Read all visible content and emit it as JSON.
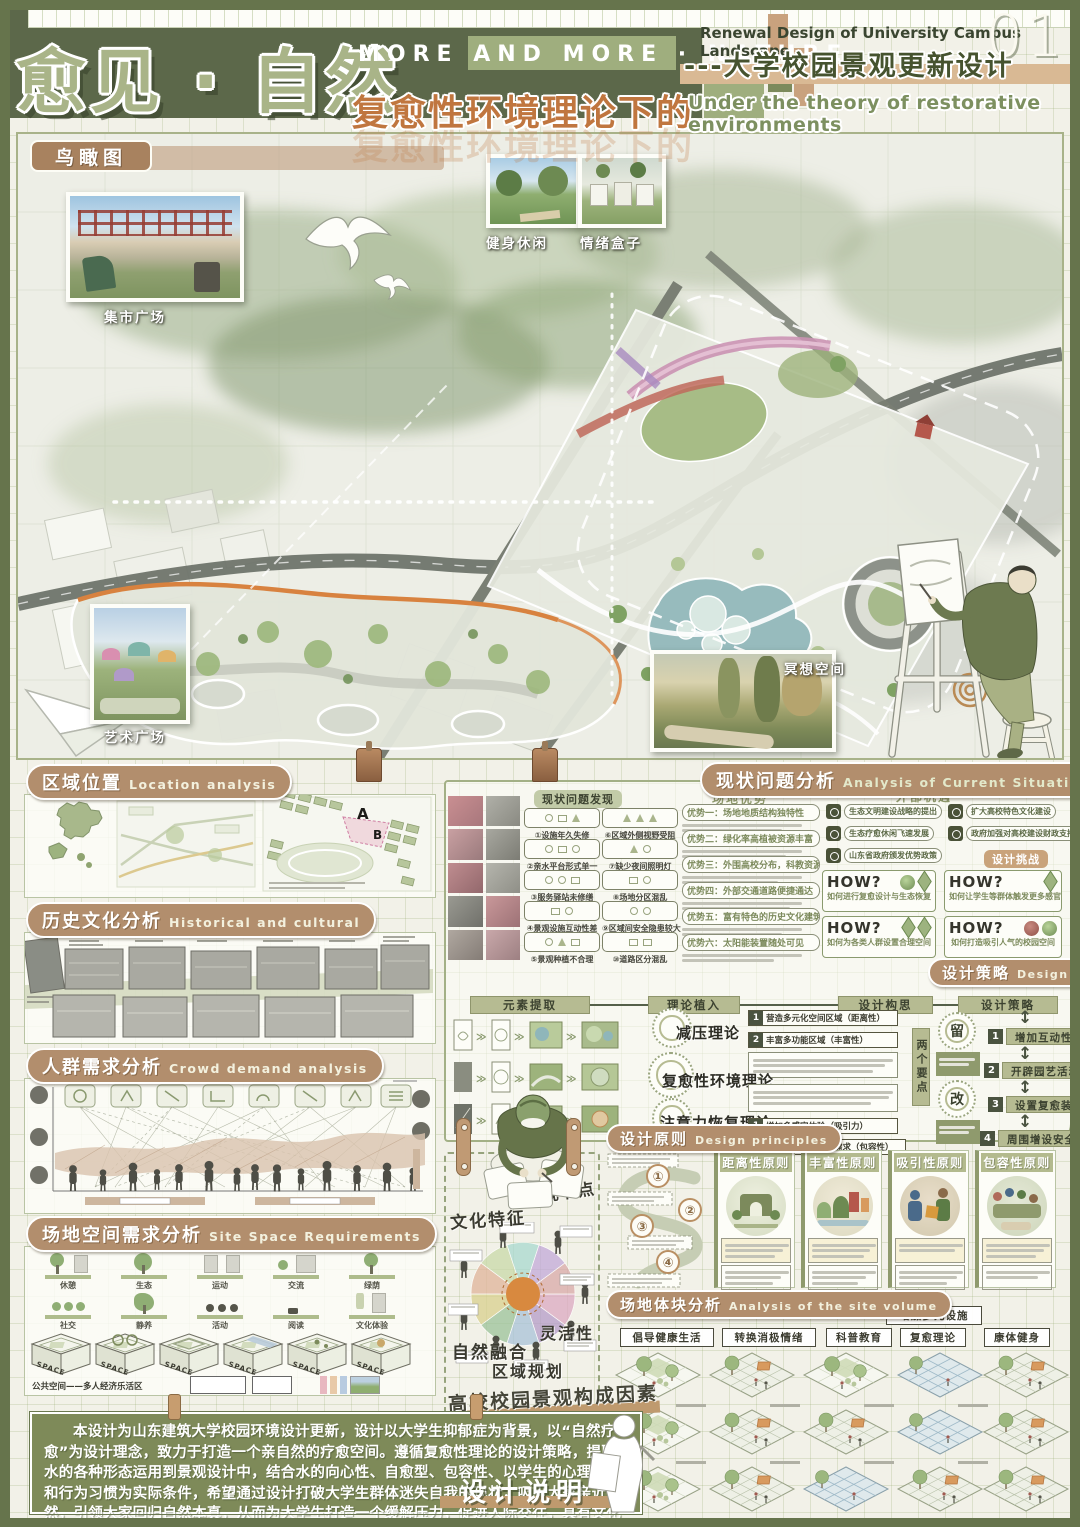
{
  "header": {
    "title": "愈见 · 自然",
    "tagline": "MORE AND MORE · NATURE",
    "subtitle": "复愈性环境理论下的",
    "en_title": "Renewal Design of University Campus Landscape",
    "page": "01",
    "cn_title": "---大学校园景观更新设计",
    "en_subtitle": "Under the theory of restorative environments"
  },
  "aerial": {
    "tag": "鸟瞰图",
    "labels": {
      "market": "集市广场",
      "fitness": "健身休闲",
      "emotion": "情绪盒子",
      "meditation": "冥想空间",
      "art": "艺术广场"
    }
  },
  "location": {
    "cn": "区域位置",
    "en": "Location analysis",
    "a": "A",
    "b": "B"
  },
  "history": {
    "cn": "历史文化分析",
    "en": "Historical and cultural"
  },
  "crowd": {
    "cn": "人群需求分析",
    "en": "Crowd demand analysis"
  },
  "sitespace": {
    "cn": "场地空间需求分析",
    "en": "Site Space Requirements",
    "row1": [
      "休憩",
      "生态",
      "运动",
      "交流",
      "绿荫"
    ],
    "row2": [
      "社交",
      "静养",
      "活动",
      "阅读",
      "文化体验"
    ],
    "cube_label": "SPACE",
    "caption": "公共空间——多人经济乐活区"
  },
  "issues": {
    "cn": "现状问题分析",
    "en": "Analysis of Current Situation Issues",
    "problems_title": "现状问题发现",
    "problems": [
      "①设施年久失修",
      "②亲水平台形式单一",
      "③服务驿站未修缮",
      "④景观设施互动性差",
      "⑤景观种植不合理",
      "⑥区域外侧视野受阻",
      "⑦缺少夜间照明灯",
      "⑧场地分区混乱",
      "⑨区域间安全隐患较大",
      "⑩道路区分混乱"
    ],
    "adv_title": "场地优势",
    "advantages": [
      "优势一：场地地质结构独特性",
      "优势二：绿化率高植被资源丰富",
      "优势三：外围高校分布，科教资源密集",
      "优势四：外部交通道路便捷通达",
      "优势五：富有特色的历史文化建筑",
      "优势六：太阳能装置随处可见"
    ],
    "opp_title": "外部机遇",
    "opportunities": [
      "生态文明建设战略的提出",
      "生态疗愈休闲飞速发展",
      "山东省政府颁发优势政策",
      "扩大高校特色文化建设",
      "政府加强对高校建设财政支持"
    ],
    "challenge_title": "设计挑战",
    "how": "HOW?",
    "challenges": [
      "如何进行复愈设计与生态恢复",
      "如何让学生等群体触发更多感官",
      "如何为各类人群设置合理空间",
      "如何打造吸引人气的校园空间"
    ]
  },
  "strategy": {
    "cn": "设计策略",
    "en": "Design strategies",
    "cols": [
      "元素提取",
      "理论植入",
      "设计构思",
      "设计策略"
    ],
    "theories": [
      "减压理论",
      "复愈性环境理论",
      "注意力恢复理论"
    ],
    "t1_items": [
      {
        "n": "1",
        "t": "营造多元化空间区域（距离性）"
      },
      {
        "n": "2",
        "t": "丰富多功能区域（丰富性）"
      }
    ],
    "t3_items": [
      {
        "n": "1",
        "t": "增加多感官体验（吸引力）"
      },
      {
        "n": "2",
        "t": "满足不同学生各项需求（包容性）"
      }
    ],
    "pivot": "两个要点",
    "keep": "留",
    "change": "改",
    "items": [
      {
        "n": "1",
        "t": "增加互动性水景"
      },
      {
        "n": "2",
        "t": "开辟园艺活动的操作区域"
      },
      {
        "n": "3",
        "t": "设置复愈装置"
      },
      {
        "n": "4",
        "t": "周围增设安全性代替措施"
      }
    ]
  },
  "principles": {
    "cn": "设计原则",
    "en": "Design principles",
    "steps": [
      "①",
      "②",
      "③",
      "④"
    ],
    "cards": [
      "距离性原则",
      "丰富性原则",
      "吸引性原则",
      "包容性原则"
    ]
  },
  "middle": {
    "labels": [
      "文化特征",
      "景观节点",
      "自然融合",
      "灵活性",
      "区域规划"
    ],
    "title": "高校校园景观构成因素"
  },
  "volume": {
    "cn": "场地体块分析",
    "en": "Analysis of the site volume",
    "tags": [
      "倡导健康生活",
      "转换消极情绪",
      "科普教育",
      "复愈理论",
      "康体健身"
    ],
    "extra_tag": "增加多元设施"
  },
  "description": {
    "title": "设计说明",
    "text": "本设计为山东建筑大学校园环境设计更新，设计以大学生抑郁症为背景，以“自然疗愈”为设计理念，致力于打造一个亲自然的疗愈空间。遵循复愈性理论的设计策略，提取水的各种形态运用到景观设计中，结合水的向心性、自愈型、包容性、以学生的心理需求和行为习惯为实际条件，希望通过设计打破大学生群体迷失自我的现状，吸引大家亲近自然，引领大家回归自然本真，从而为大学生打造一个缓解压力，促进人际交往，具有文化内涵的校园环境。"
  }
}
